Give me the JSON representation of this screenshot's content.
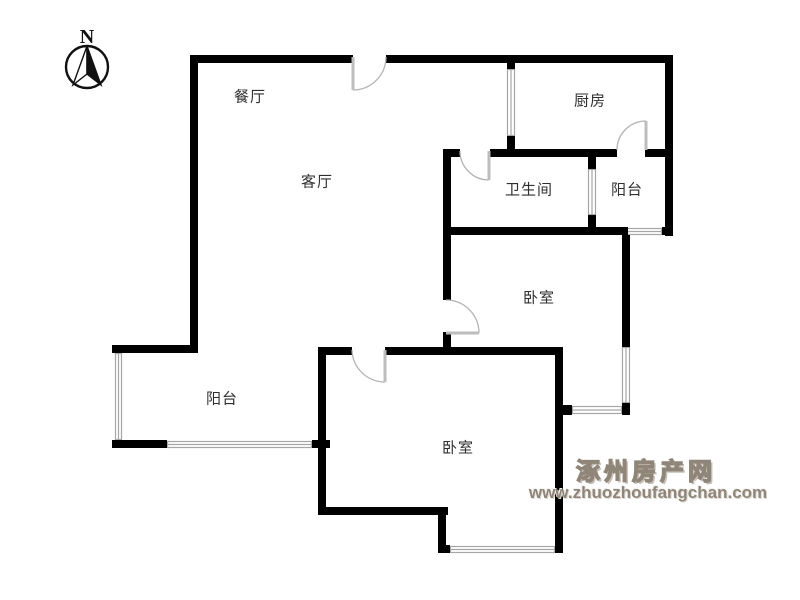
{
  "compass": {
    "label": "N"
  },
  "watermark": {
    "site_name": "涿州房产网",
    "site_url": "www.zhuozhoufangchan.com",
    "color": "#8f8579"
  },
  "rooms": [
    {
      "id": "dining-room",
      "label": "餐厅",
      "x": 250,
      "y": 96
    },
    {
      "id": "living-room",
      "label": "客厅",
      "x": 317,
      "y": 181
    },
    {
      "id": "kitchen",
      "label": "厨房",
      "x": 590,
      "y": 100
    },
    {
      "id": "bathroom",
      "label": "卫生间",
      "x": 529,
      "y": 189
    },
    {
      "id": "balcony-east",
      "label": "阳台",
      "x": 627,
      "y": 189
    },
    {
      "id": "bedroom-north",
      "label": "卧室",
      "x": 539,
      "y": 297
    },
    {
      "id": "balcony-west",
      "label": "阳台",
      "x": 222,
      "y": 398
    },
    {
      "id": "bedroom-south",
      "label": "卧室",
      "x": 458,
      "y": 447
    }
  ],
  "plan": {
    "wall_color": "#000000",
    "window_color": "#a6a6a6",
    "door_color": "#b3b3b3",
    "walls": [
      [
        190,
        55,
        163,
        8
      ],
      [
        386,
        55,
        287,
        8
      ],
      [
        190,
        55,
        8,
        298
      ],
      [
        507,
        55,
        8,
        14
      ],
      [
        507,
        136,
        8,
        14
      ],
      [
        665,
        55,
        8,
        181
      ],
      [
        443,
        149,
        17,
        8
      ],
      [
        490,
        149,
        127,
        8
      ],
      [
        645,
        149,
        28,
        8
      ],
      [
        588,
        149,
        8,
        20
      ],
      [
        588,
        215,
        8,
        20
      ],
      [
        443,
        227,
        185,
        8
      ],
      [
        662,
        227,
        11,
        8
      ],
      [
        443,
        149,
        8,
        151
      ],
      [
        443,
        332,
        8,
        16
      ],
      [
        622,
        235,
        8,
        112
      ],
      [
        622,
        403,
        8,
        12
      ],
      [
        563,
        405,
        9,
        10
      ],
      [
        318,
        347,
        34,
        8
      ],
      [
        385,
        347,
        178,
        8
      ],
      [
        112,
        345,
        86,
        8
      ],
      [
        112,
        440,
        55,
        8
      ],
      [
        312,
        440,
        18,
        8
      ],
      [
        318,
        347,
        8,
        168
      ],
      [
        318,
        507,
        130,
        8
      ],
      [
        438,
        507,
        8,
        46
      ],
      [
        438,
        545,
        12,
        8
      ],
      [
        555,
        347,
        8,
        206
      ]
    ],
    "windows": [
      {
        "name": "kitchen-west-window",
        "x": 507,
        "y": 69,
        "w": 8,
        "h": 67,
        "orient": "v"
      },
      {
        "name": "bathroom-balcony-divider-window",
        "x": 588,
        "y": 169,
        "w": 8,
        "h": 46,
        "orient": "v"
      },
      {
        "name": "balcony-east-south-window",
        "x": 627,
        "y": 228,
        "w": 35,
        "h": 7,
        "orient": "h"
      },
      {
        "name": "bedroom-north-east-window",
        "x": 622,
        "y": 347,
        "w": 8,
        "h": 56,
        "orient": "v"
      },
      {
        "name": "bay-south-window",
        "x": 572,
        "y": 406,
        "w": 50,
        "h": 8,
        "orient": "h"
      },
      {
        "name": "balcony-west-west-window",
        "x": 115,
        "y": 353,
        "w": 7,
        "h": 87,
        "orient": "v"
      },
      {
        "name": "balcony-west-south-window",
        "x": 167,
        "y": 441,
        "w": 145,
        "h": 7,
        "orient": "h"
      },
      {
        "name": "bedroom-south-south-window",
        "x": 450,
        "y": 546,
        "w": 105,
        "h": 7,
        "orient": "h"
      }
    ],
    "doors": [
      {
        "name": "entrance-door",
        "arc": "M 353 90 A 33 33 0 0 0 386 57",
        "leaf": [
          353,
          57,
          353,
          90
        ]
      },
      {
        "name": "kitchen-door",
        "arc": "M 617 150 A 29 29 0 0 1 646 121",
        "leaf": [
          646,
          150,
          646,
          121
        ]
      },
      {
        "name": "bathroom-door",
        "arc": "M 460 151 A 29 29 0 0 0 489 180",
        "leaf": [
          489,
          151,
          489,
          180
        ]
      },
      {
        "name": "bedroom-north-door",
        "arc": "M 446 300 A 33 33 0 0 1 479 333",
        "leaf": [
          446,
          333,
          479,
          333
        ]
      },
      {
        "name": "bedroom-south-door",
        "arc": "M 352 350 A 33 33 0 0 0 385 382",
        "leaf": [
          385,
          350,
          385,
          382
        ]
      }
    ]
  }
}
